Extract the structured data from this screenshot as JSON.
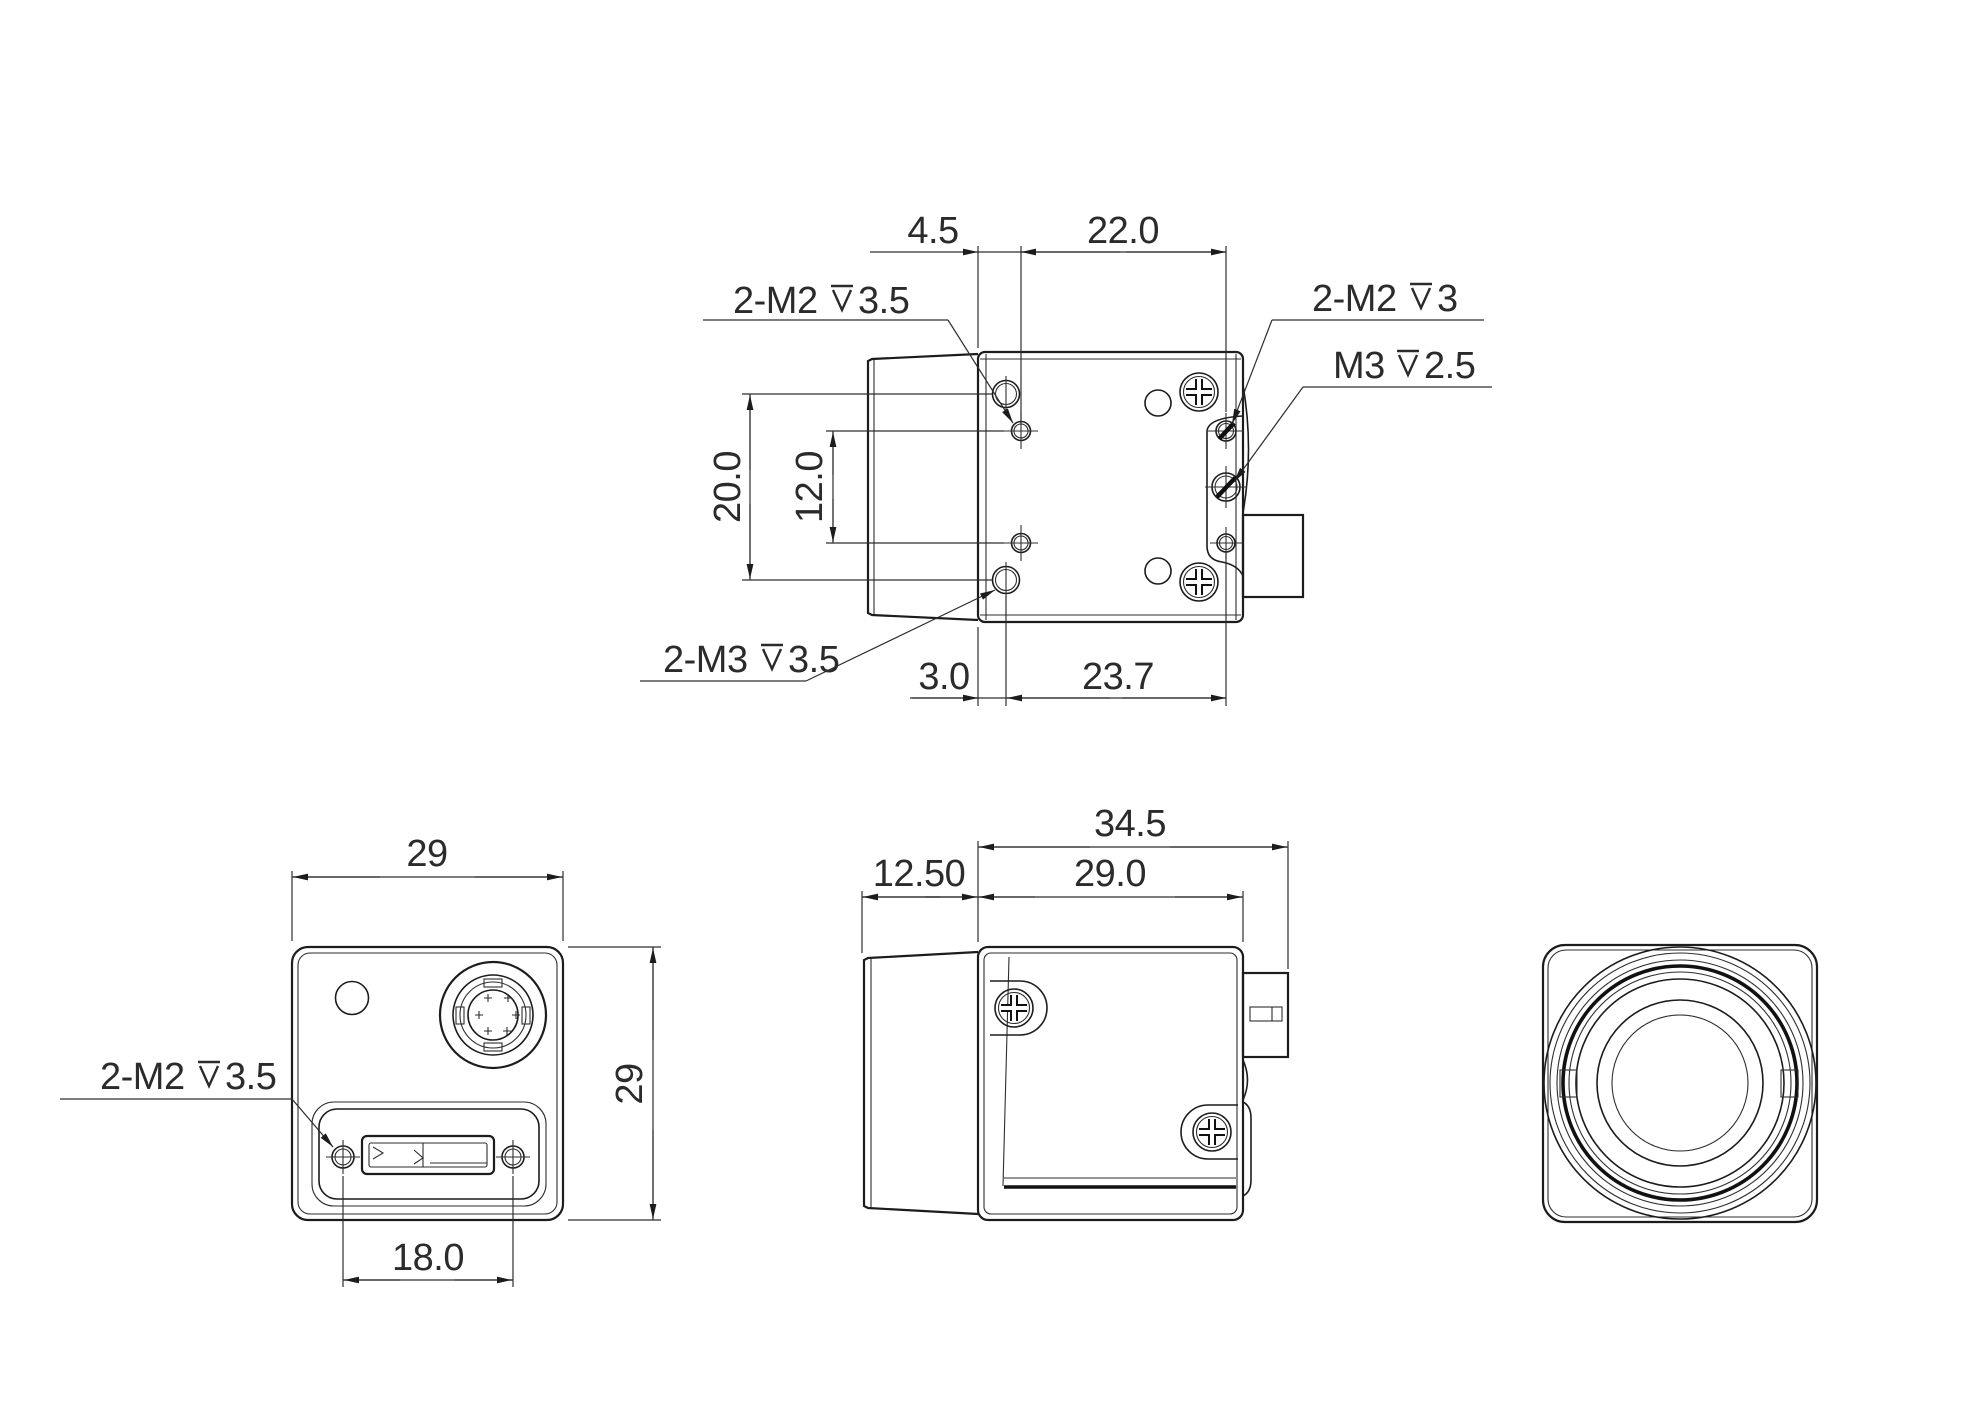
{
  "top_view": {
    "dim_top_left": "4.5",
    "dim_top_right": "22.0",
    "dim_left_outer": "20.0",
    "dim_left_inner": "12.0",
    "dim_bottom_left": "3.0",
    "dim_bottom_right": "23.7",
    "label_left_top": {
      "prefix": "2-M2",
      "depth": "3.5"
    },
    "label_left_bottom": {
      "prefix": "2-M3",
      "depth": "3.5"
    },
    "label_right_top": {
      "prefix": "2-M2",
      "depth": "3"
    },
    "label_right_mid": {
      "prefix": "M3",
      "depth": "2.5"
    }
  },
  "side_view": {
    "dim_total_length": "34.5",
    "dim_lens_length": "12.50",
    "dim_body_length": "29.0"
  },
  "back_view": {
    "dim_width": "29",
    "dim_height": "29",
    "dim_usb_spacing": "18.0",
    "label_screws": {
      "prefix": "2-M2",
      "depth": "3.5"
    }
  }
}
